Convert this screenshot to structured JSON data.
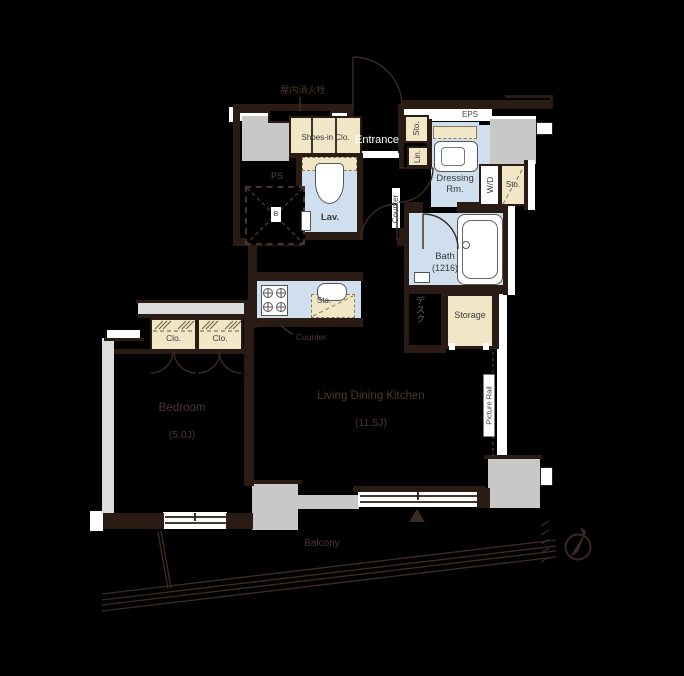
{
  "floor_plan": {
    "service": {
      "fire_hydrant": "屋内消火栓",
      "eps": "EPS",
      "ps": "PS",
      "shaft_mark": "B"
    },
    "entry": {
      "entrance": "Entrance",
      "shoes_closet": "Shoes-in Clo.",
      "storage_small": "Sto.",
      "linen": "Lin."
    },
    "sanitary": {
      "lavatory": "Lav.",
      "lavatory_storage": "Sto.",
      "dressing_room_line1": "Dressing",
      "dressing_room_line2": "Rm.",
      "washer_dryer": "W/D",
      "washer_storage": "Sto.",
      "bath_name": "Bath",
      "bath_size": "(1216)"
    },
    "kitchen": {
      "storage": "Sto.",
      "counter_label": "Counter",
      "counter_side_label": "Counter"
    },
    "living": {
      "name": "Living Dining Kitchen",
      "size": "(11.5J)",
      "picture_rail": "Picture Rail",
      "desk": "デスク",
      "storage": "Storage"
    },
    "bedroom": {
      "name": "Bedroom",
      "size": "(5.0J)",
      "closet_left": "Clo.",
      "closet_right": "Clo."
    },
    "outdoor": {
      "balcony": "Balcony"
    },
    "colors": {
      "background": "#000000",
      "wall": "#2a1b15",
      "concrete": "#c8c8c9",
      "room_fill_blue": "#cfdfee",
      "closet_fill_beige": "#f1e7c7",
      "outline_white": "#ffffff",
      "faint_brown_line": "#4c362c"
    }
  }
}
